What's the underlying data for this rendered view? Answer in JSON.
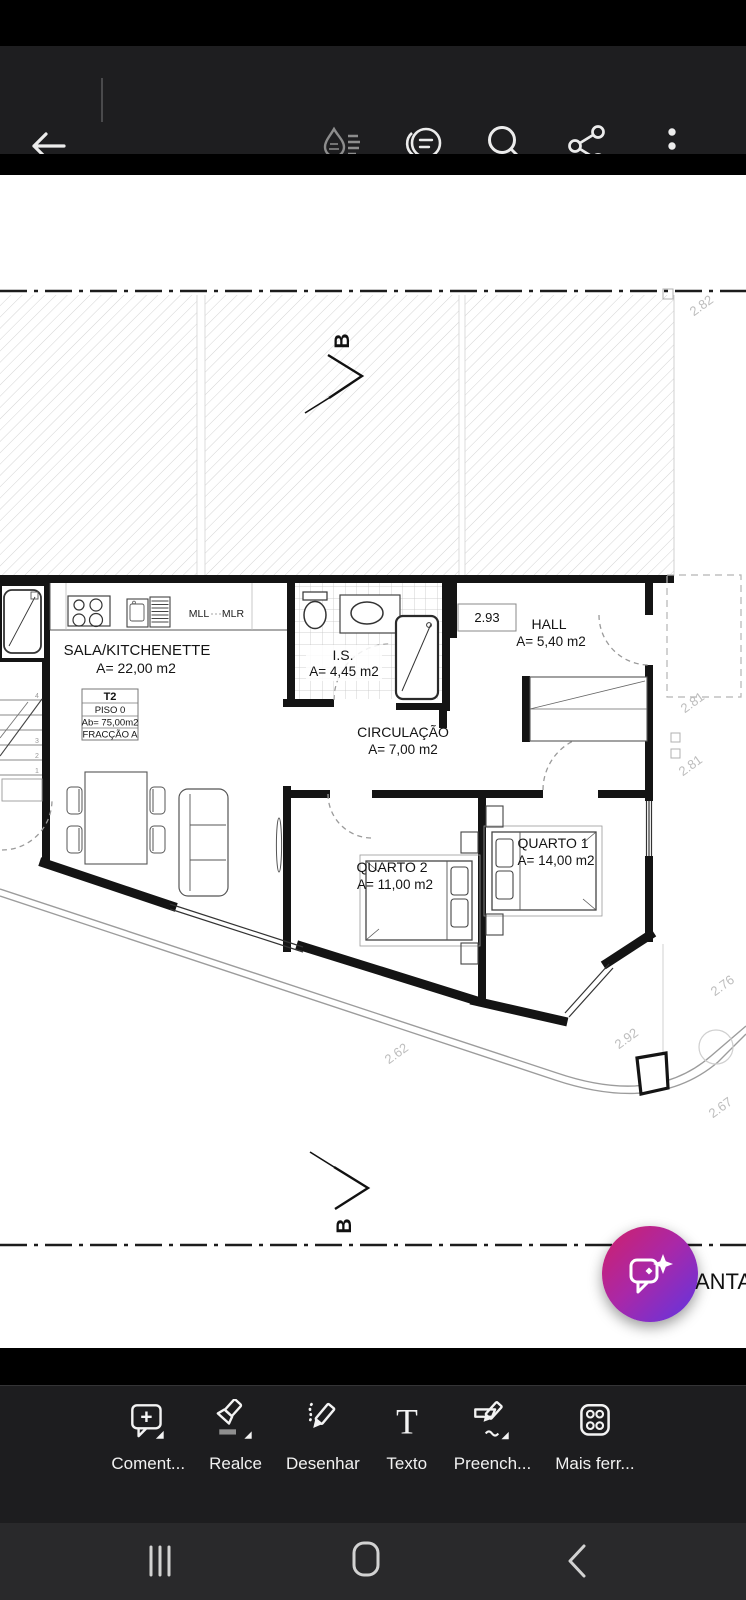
{
  "app_bar": {
    "icons": [
      "back-arrow",
      "liquid-mode",
      "page-view",
      "search",
      "share",
      "more-options"
    ]
  },
  "plan": {
    "section_marker": "B",
    "level_box": "2.93",
    "rooms": {
      "sala": {
        "name": "SALA/KITCHENETTE",
        "area": "A= 22,00 m2"
      },
      "is": {
        "name": "I.S.",
        "area": "A= 4,45 m2"
      },
      "hall": {
        "name": "HALL",
        "area": "A= 5,40 m2"
      },
      "circulacao": {
        "name": "CIRCULAÇÃO",
        "area": "A= 7,00 m2"
      },
      "quarto1": {
        "name": "QUARTO 1",
        "area": "A= 14,00 m2"
      },
      "quarto2": {
        "name": "QUARTO 2",
        "area": "A= 11,00 m2"
      }
    },
    "kitchen_labels": {
      "mll": "MLL",
      "mlr": "MLR"
    },
    "unit_box": {
      "row1": "T2",
      "row2": "PISO 0",
      "row3": "Ab= 75,00m2",
      "row4": "FRACÇÃO A"
    },
    "stair_numbers": {
      "n4": "4",
      "n3": "3",
      "n2": "2",
      "n1": "1"
    },
    "dimensions": {
      "top_right": "2.82",
      "right_upper": "2.81",
      "right_lower": "2.81",
      "bottom_left": "2.62",
      "bottom_middle": "2.92",
      "bottom_right_upper": "2.76",
      "bottom_right_lower": "2.67"
    },
    "clipped_text": "ANTA"
  },
  "fab": {
    "icon": "ai-chat-sparkle"
  },
  "tools": {
    "items": [
      {
        "label": "Coment...",
        "icon": "comment-add"
      },
      {
        "label": "Realce",
        "icon": "highlighter"
      },
      {
        "label": "Desenhar",
        "icon": "pencil-draw"
      },
      {
        "label": "Texto",
        "icon": "text-tool",
        "glyph": "T"
      },
      {
        "label": "Preench...",
        "icon": "fill-and-sign"
      },
      {
        "label": "Mais ferr...",
        "icon": "more-tools"
      }
    ]
  },
  "nav_bar": {
    "icons": [
      "recents",
      "home",
      "back"
    ]
  }
}
